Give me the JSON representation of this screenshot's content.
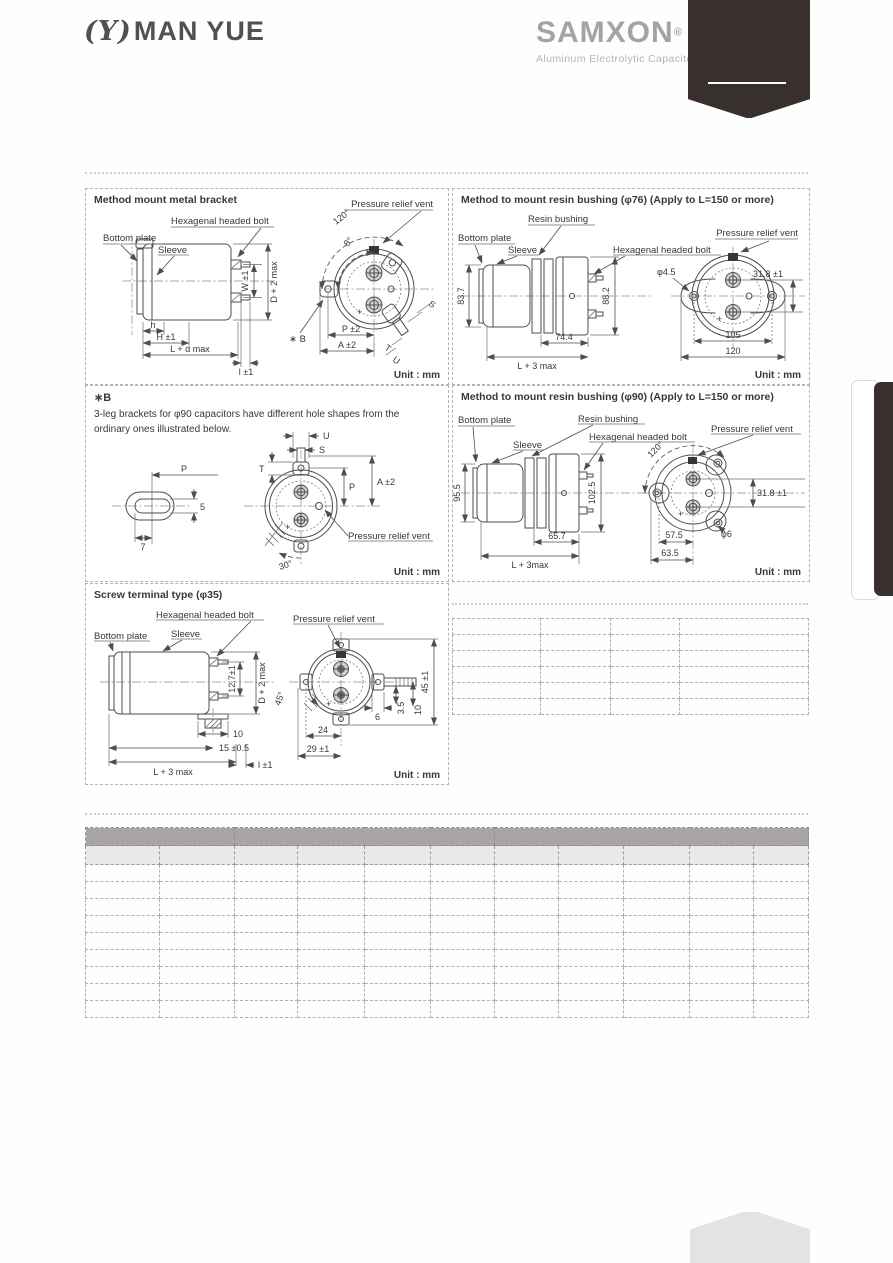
{
  "header": {
    "manyue_mark": "(Υ)",
    "manyue_name": "MAN YUE",
    "samxon_name": "SAMXON",
    "samxon_reg": "®",
    "samxon_tagline": "Aluminum Electrolytic Capacitors"
  },
  "colors": {
    "ribbon_dark": "#37302d",
    "logo_gray": "#a5a2a2",
    "table_header_dark": "#a9a5a5",
    "table_header_light": "#eae8e8"
  },
  "marks": {
    "plus": "+"
  },
  "panels": {
    "metal_bracket": {
      "title": "Method mount metal bracket",
      "bottom_plate": "Bottom plate",
      "hex_bolt": "Hexagenal headed bolt",
      "sleeve": "Sleeve",
      "vent": "Pressure relief vent",
      "deg120": "120°",
      "theta": "θ°",
      "ref_b": "∗ B",
      "dim_p": "P ±2",
      "dim_a": "A ±2",
      "dim_w": "W ±1",
      "dim_d": "D + 2 max",
      "dim_h_small": "h",
      "dim_h": "H ±1",
      "dim_len": "L + α max",
      "dim_l": "l ±1",
      "dim_s": "S",
      "dim_t": "T",
      "dim_u": "U",
      "unit": "Unit : mm"
    },
    "resin76": {
      "title": "Method to mount resin bushing (φ76) (Apply to L=150 or more)",
      "resin_bushing": "Resin bushing",
      "bottom_plate": "Bottom plate",
      "sleeve": "Sleeve",
      "hex_bolt": "Hexagenal headed bolt",
      "vent": "Pressure relief vent",
      "dim_body_h": "83.7",
      "dim_flange_h": "88.2",
      "dim_bushing": "74.4",
      "dim_len": "L + 3 max",
      "dim_hole": "φ4.5",
      "dim_term": "31.8 ±1",
      "dim_pitch": "105",
      "dim_width": "120",
      "unit": "Unit : mm"
    },
    "note_b": {
      "ref": "∗B",
      "line1": "3-leg brackets for φ90 capacitors have different hole shapes from the",
      "line2": "ordinary ones illustrated below.",
      "dim_p_left": "P",
      "dim_5": "5",
      "dim_7": "7",
      "dim_u": "U",
      "dim_s": "S",
      "dim_t": "T",
      "dim_p": "P",
      "dim_a": "A ±2",
      "vent": "Pressure relief vent",
      "deg30": "30°",
      "unit": "Unit : mm"
    },
    "resin90": {
      "title": "Method to mount resin bushing (φ90) (Apply to L=150 or more)",
      "bottom_plate": "Bottom plate",
      "resin_bushing": "Resin bushing",
      "sleeve": "Sleeve",
      "hex_bolt": "Hexagenal headed bolt",
      "vent": "Pressure relief vent",
      "dim_body_h": "95.5",
      "dim_flange_h": "102.5",
      "dim_bushing": "65.7",
      "dim_len": "L + 3max",
      "deg120": "120°",
      "dim_term": "31.8 ±1",
      "dim_hole": "φ6",
      "dim_575": "57.5",
      "dim_635": "63.5",
      "unit": "Unit : mm"
    },
    "screw35": {
      "title": "Screw terminal type (φ35)",
      "hex_bolt": "Hexagenal headed bolt",
      "bottom_plate": "Bottom plate",
      "sleeve": "Sleeve",
      "vent": "Pressure relief vent",
      "dim_127": "12.7±1",
      "dim_d": "D + 2 max",
      "dim_10": "10",
      "dim_15": "15 ±0.5",
      "dim_len": "L + 3 max",
      "dim_l": "l ±1",
      "deg45": "45°",
      "dim_6": "6",
      "dim_35": "3.5",
      "dim_10b": "10",
      "dim_45": "45 ±1",
      "dim_24": "24",
      "dim_29": "29 ±1",
      "unit": "Unit : mm"
    }
  },
  "tables": {
    "small": {
      "columns": 4,
      "data_rows": 6,
      "col_widths": [
        88,
        70,
        69,
        129
      ]
    },
    "large": {
      "columns": 11,
      "data_rows": 9,
      "group_header_spans": [
        2,
        4,
        5
      ],
      "sub_header": true,
      "col_widths": [
        74,
        75,
        63,
        67,
        66,
        64,
        64,
        65,
        66,
        64,
        55
      ]
    }
  }
}
